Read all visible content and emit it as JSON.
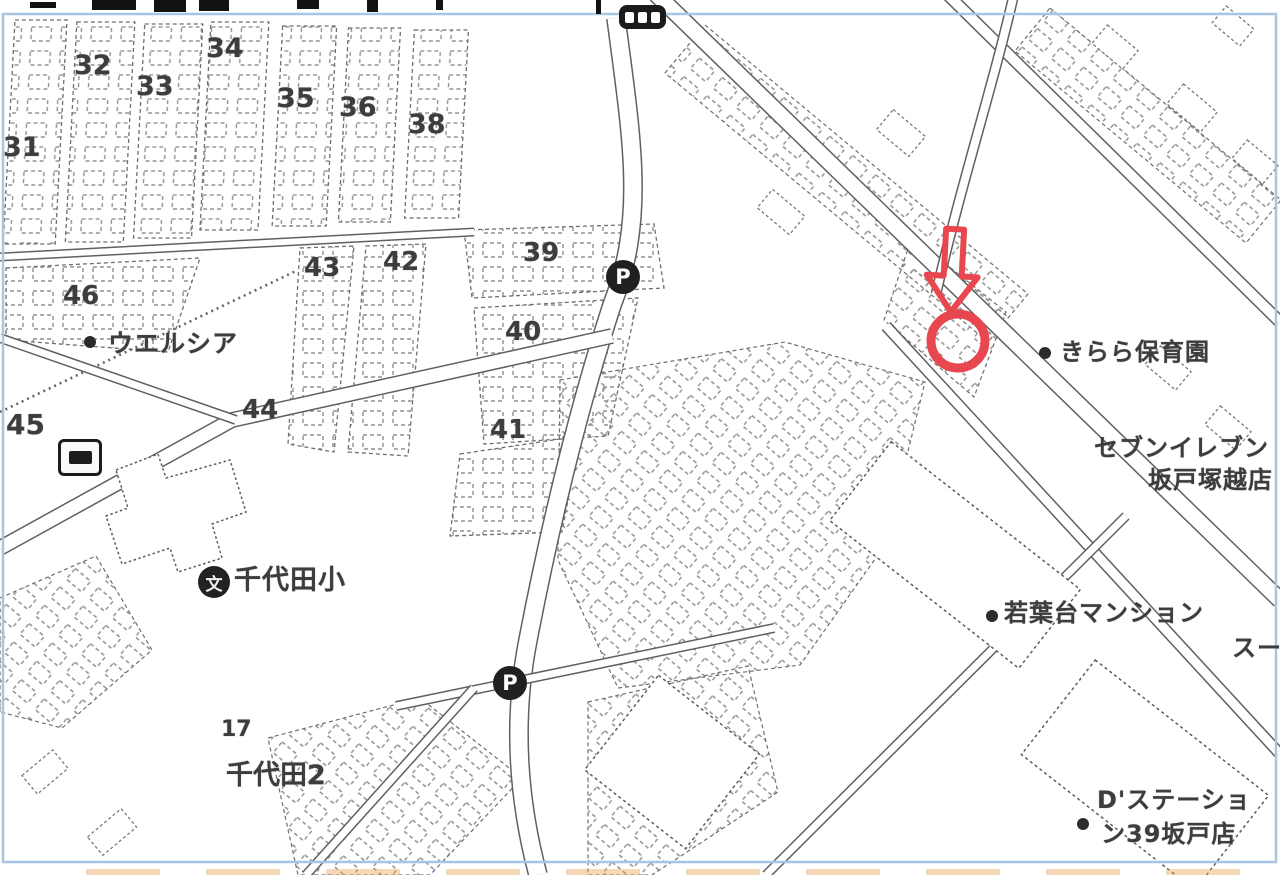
{
  "map": {
    "frame_color": "#a6c6e4",
    "marker_color": "#e8474f",
    "ink_color": "#3d3d3d",
    "block_numbers": [
      {
        "name": "block-31",
        "text": "31",
        "x": 3,
        "y": 134,
        "size": 27
      },
      {
        "name": "block-32",
        "text": "32",
        "x": 74,
        "y": 52,
        "size": 27
      },
      {
        "name": "block-33",
        "text": "33",
        "x": 136,
        "y": 73,
        "size": 27
      },
      {
        "name": "block-34",
        "text": "34",
        "x": 206,
        "y": 35,
        "size": 27
      },
      {
        "name": "block-35",
        "text": "35",
        "x": 277,
        "y": 85,
        "size": 27
      },
      {
        "name": "block-36",
        "text": "36",
        "x": 339,
        "y": 94,
        "size": 27
      },
      {
        "name": "block-38",
        "text": "38",
        "x": 408,
        "y": 111,
        "size": 27
      },
      {
        "name": "block-39",
        "text": "39",
        "x": 523,
        "y": 240,
        "size": 26
      },
      {
        "name": "block-40",
        "text": "40",
        "x": 505,
        "y": 319,
        "size": 26
      },
      {
        "name": "block-41",
        "text": "41",
        "x": 490,
        "y": 417,
        "size": 26
      },
      {
        "name": "block-42",
        "text": "42",
        "x": 383,
        "y": 249,
        "size": 26
      },
      {
        "name": "block-43",
        "text": "43",
        "x": 304,
        "y": 255,
        "size": 26
      },
      {
        "name": "block-44",
        "text": "44",
        "x": 242,
        "y": 397,
        "size": 26
      },
      {
        "name": "block-45",
        "text": "45",
        "x": 6,
        "y": 411,
        "size": 28
      },
      {
        "name": "block-46",
        "text": "46",
        "x": 63,
        "y": 283,
        "size": 26
      },
      {
        "name": "block-17",
        "text": "17",
        "x": 221,
        "y": 719,
        "size": 22
      }
    ],
    "area_labels": [
      {
        "name": "district-chiyoda-2",
        "text": "千代田2",
        "x": 226,
        "y": 762,
        "size": 27
      }
    ],
    "poi_labels": [
      {
        "name": "poi-welcia",
        "text": "ウエルシア",
        "x": 108,
        "y": 331,
        "size": 25
      },
      {
        "name": "poi-chiyoda-elementary",
        "text": "千代田小",
        "x": 234,
        "y": 567,
        "size": 27
      },
      {
        "name": "poi-kirara-nursery",
        "text": "きらら保育園",
        "x": 1060,
        "y": 340,
        "size": 24
      },
      {
        "name": "poi-seven-eleven-line1",
        "text": "セブンイレブン",
        "x": 1094,
        "y": 436,
        "size": 24
      },
      {
        "name": "poi-seven-eleven-line2",
        "text": "坂戸塚越店",
        "x": 1148,
        "y": 468,
        "size": 24
      },
      {
        "name": "poi-wakabadai-mansion",
        "text": "若葉台マンション",
        "x": 1004,
        "y": 601,
        "size": 24
      },
      {
        "name": "poi-super-cutoff",
        "text": "スー",
        "x": 1232,
        "y": 636,
        "size": 24
      },
      {
        "name": "poi-d-station-line1",
        "text": "D'ステーショ",
        "x": 1097,
        "y": 788,
        "size": 24
      },
      {
        "name": "poi-d-station-line2",
        "text": "ン39坂戸店",
        "x": 1101,
        "y": 822,
        "size": 24
      }
    ],
    "poi_bullets": [
      {
        "name": "bullet-welcia",
        "x": 84,
        "y": 336
      },
      {
        "name": "bullet-kirara-nursery",
        "x": 1039,
        "y": 347
      },
      {
        "name": "bullet-wakabadai-mansion",
        "x": 986,
        "y": 610
      },
      {
        "name": "bullet-d-station",
        "x": 1077,
        "y": 818
      }
    ],
    "icons": [
      {
        "name": "bus-stop-icon-top",
        "type": "bus",
        "x": 619,
        "y": 5
      },
      {
        "name": "parking-icon-north",
        "type": "parking",
        "glyph": "P",
        "x": 606,
        "y": 260
      },
      {
        "name": "parking-icon-south",
        "type": "parking",
        "glyph": "P",
        "x": 493,
        "y": 666
      },
      {
        "name": "bus-stop-icon-west",
        "type": "bus-framed",
        "x": 58,
        "y": 439
      },
      {
        "name": "school-icon",
        "type": "school",
        "glyph": "文",
        "x": 198,
        "y": 566
      }
    ]
  }
}
